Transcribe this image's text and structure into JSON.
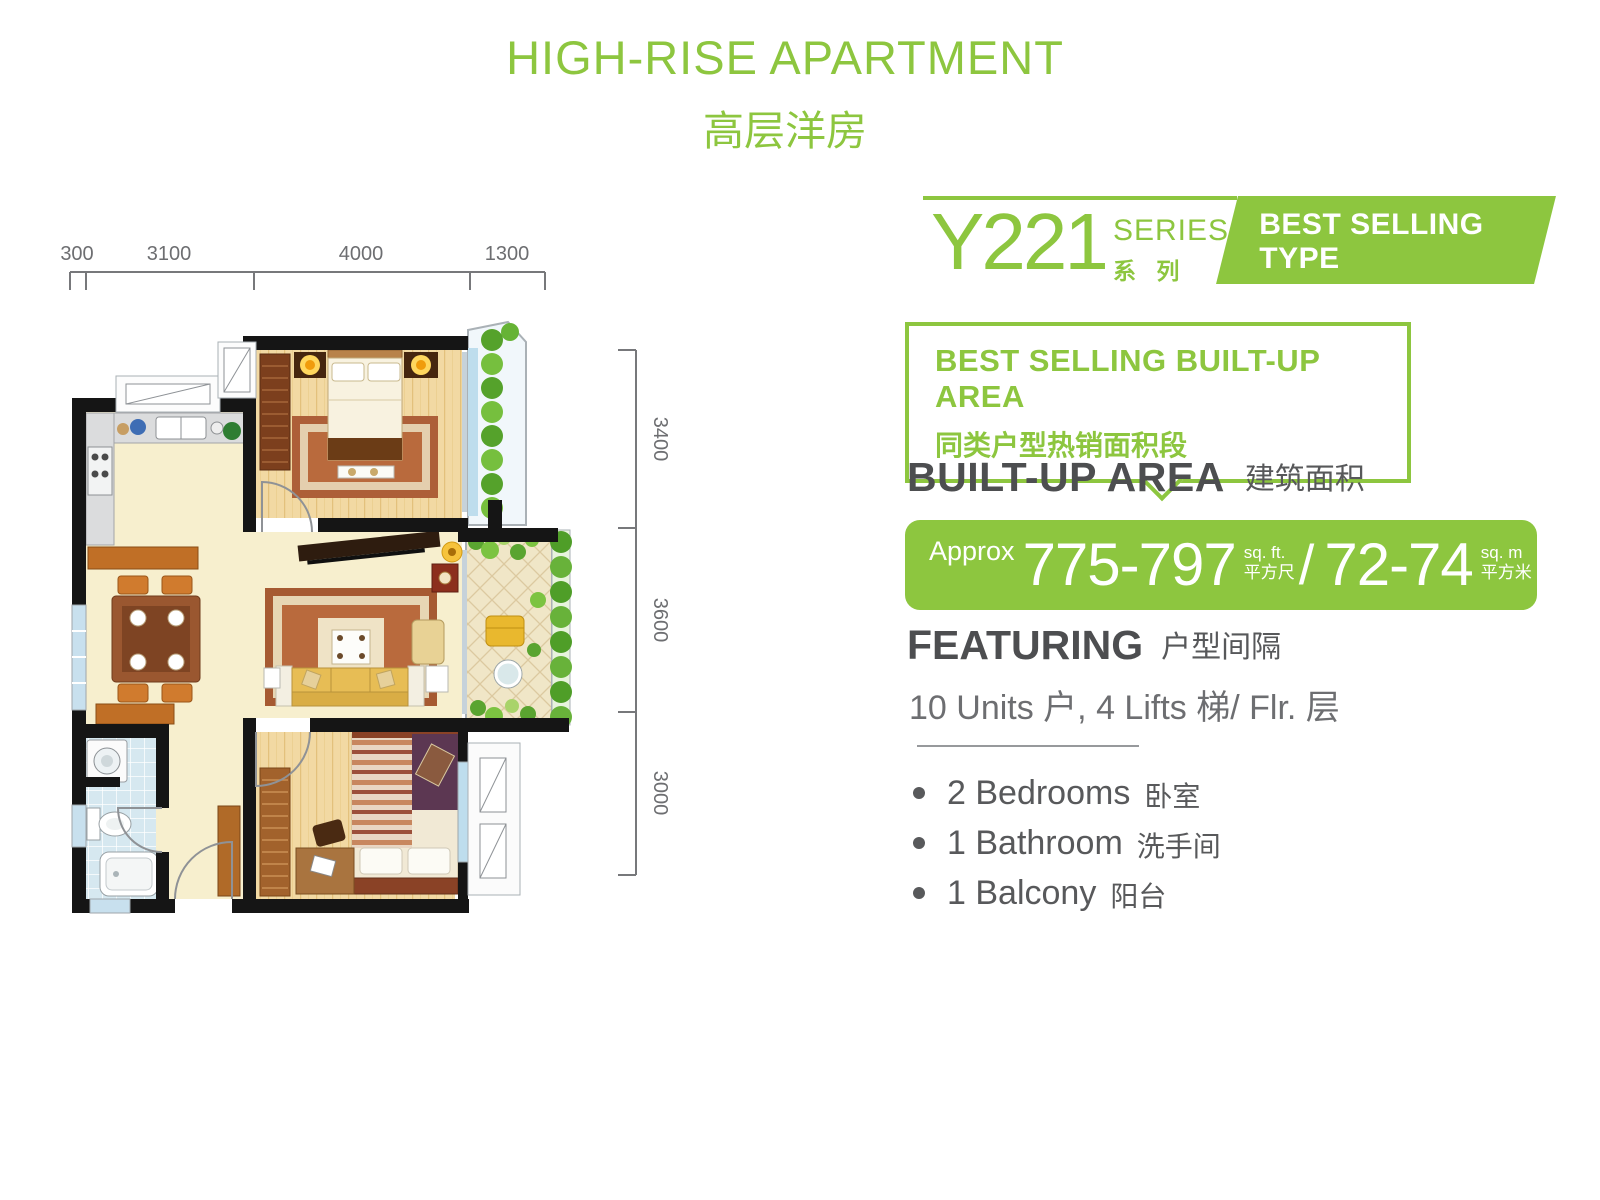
{
  "page": {
    "title_en": "HIGH-RISE APARTMENT",
    "title_zh": "高层洋房"
  },
  "series": {
    "code": "Y221",
    "label_en": "SERIES",
    "label_zh": "系 列",
    "badge_line1": "BEST SELLING TYPE",
    "badge_line2": "热销户型"
  },
  "callout": {
    "line1": "BEST SELLING BUILT-UP AREA",
    "line2": "同类户型热销面积段"
  },
  "built_up_area": {
    "label_en": "BUILT-UP AREA",
    "label_zh": "建筑面积",
    "approx": "Approx",
    "sqft_value": "775-797",
    "sqft_unit_en": "sq. ft.",
    "sqft_unit_zh": "平方尺",
    "slash": "/",
    "sqm_value": "72-74",
    "sqm_unit_en": "sq. m",
    "sqm_unit_zh": "平方米"
  },
  "featuring": {
    "label_en": "FEATURING",
    "label_zh": "户型间隔",
    "units_line": "10 Units 户, 4 Lifts 梯/ Flr. 层"
  },
  "features": [
    {
      "en": "2 Bedrooms",
      "zh": "卧室"
    },
    {
      "en": "1 Bathroom",
      "zh": "洗手间"
    },
    {
      "en": "1 Balcony",
      "zh": "阳台"
    }
  ],
  "floorplan": {
    "dims_top": [
      "300",
      "3100",
      "4000",
      "1300"
    ],
    "dims_right": [
      "3400",
      "3600",
      "3000"
    ]
  },
  "colors": {
    "accent_green": "#8dc63f",
    "heading_gray": "#4d4e50",
    "body_gray": "#58595b"
  }
}
